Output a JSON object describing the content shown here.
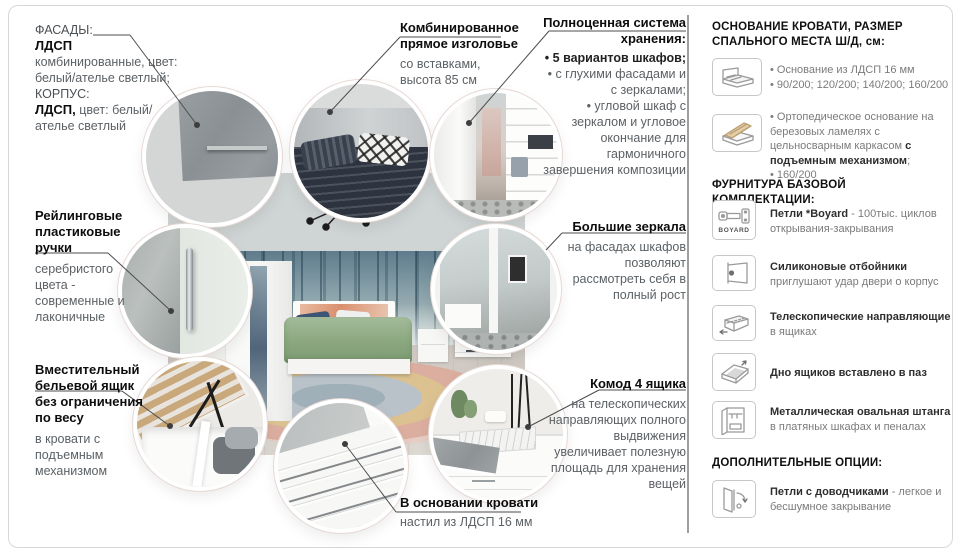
{
  "colors": {
    "text_dark": "#0d0d0d",
    "text_gray": "#5c6165",
    "leader_line": "#4d4d4d",
    "duvet_green": "#8aa77f",
    "concrete": "#9ba1a3"
  },
  "left_column": {
    "materials": {
      "label1": "ФАСАДЫ:",
      "bold1": "ЛДСП",
      "text1": "комбинированные, цвет: белый/ателье светлый;",
      "label2": "КОРПУС:",
      "bold2": "ЛДСП,",
      "text2": " цвет: белый/ателье светлый"
    },
    "handles": {
      "title": "Рейлинговые пластиковые ручки",
      "body": "серебристого цвета - современные и лаконичные"
    },
    "linen_drawer": {
      "title": "Вместительный бельевой ящик без ограничения по весу",
      "body": "в кровати с подъемным механизмом"
    }
  },
  "callouts": {
    "headboard": {
      "title": "Комбинированное прямое изголовье",
      "body": "со вставками, высота 85 см"
    },
    "storage": {
      "title": "Полноценная система хранения:",
      "bullets": [
        "• 5 вариантов шкафов;",
        "• с глухими фасадами и с зеркалами;",
        "• угловой шкаф с зеркалом и угловое окончание для гармоничного завершения композиции"
      ]
    },
    "mirrors": {
      "title": "Большие зеркала",
      "body": "на фасадах шкафов позволяют рассмотреть себя в полный рост"
    },
    "chest": {
      "title": "Комод 4 ящика",
      "body": "на телескопических направляющих полного выдвижения увеличивает полезную площадь для хранения вещей"
    },
    "bed_base": {
      "title": "В основании кровати",
      "body": "настил из ЛДСП 16 мм"
    }
  },
  "right_panel": {
    "section_base": {
      "header": "ОСНОВАНИЕ КРОВАТИ, РАЗМЕР СПАЛЬНОГО МЕСТА Ш/Д, см:",
      "item1": {
        "bullet1": "• Основание из ЛДСП 16 мм",
        "bullet2": "• 90/200; 120/200; 140/200; 160/200"
      },
      "item2": {
        "pre": "• Ортопедическое основание на березовых ламелях с цельносварным каркасом ",
        "bold": "с подъемным механизмом",
        "post": ";",
        "bullet2": "• 160/200"
      }
    },
    "section_hardware": {
      "header": "ФУРНИТУРА БАЗОВОЙ КОМПЛЕКТАЦИИ:",
      "hinge": {
        "icon_label": "BOYARD",
        "bold": "Петли *Boyard",
        "rest": " - 100тыс. циклов открывания-закрывания"
      },
      "bumper": {
        "bold": "Силиконовые отбойники",
        "rest": "приглушают удар двери о корпус"
      },
      "slides": {
        "bold": "Телескопические направляющие",
        "rest": "в ящиках"
      },
      "bottom": {
        "bold": "Дно ящиков вставлено в паз",
        "rest": ""
      },
      "rod": {
        "bold": "Металлическая овальная штанга",
        "rest": " в платяных шкафах и пеналах"
      }
    },
    "section_options": {
      "header": "ДОПОЛНИТЕЛЬНЫЕ ОПЦИИ:",
      "closer": {
        "bold": "Петли с доводчиками",
        "rest": " - легкое и бесшумное закрывание"
      }
    }
  }
}
